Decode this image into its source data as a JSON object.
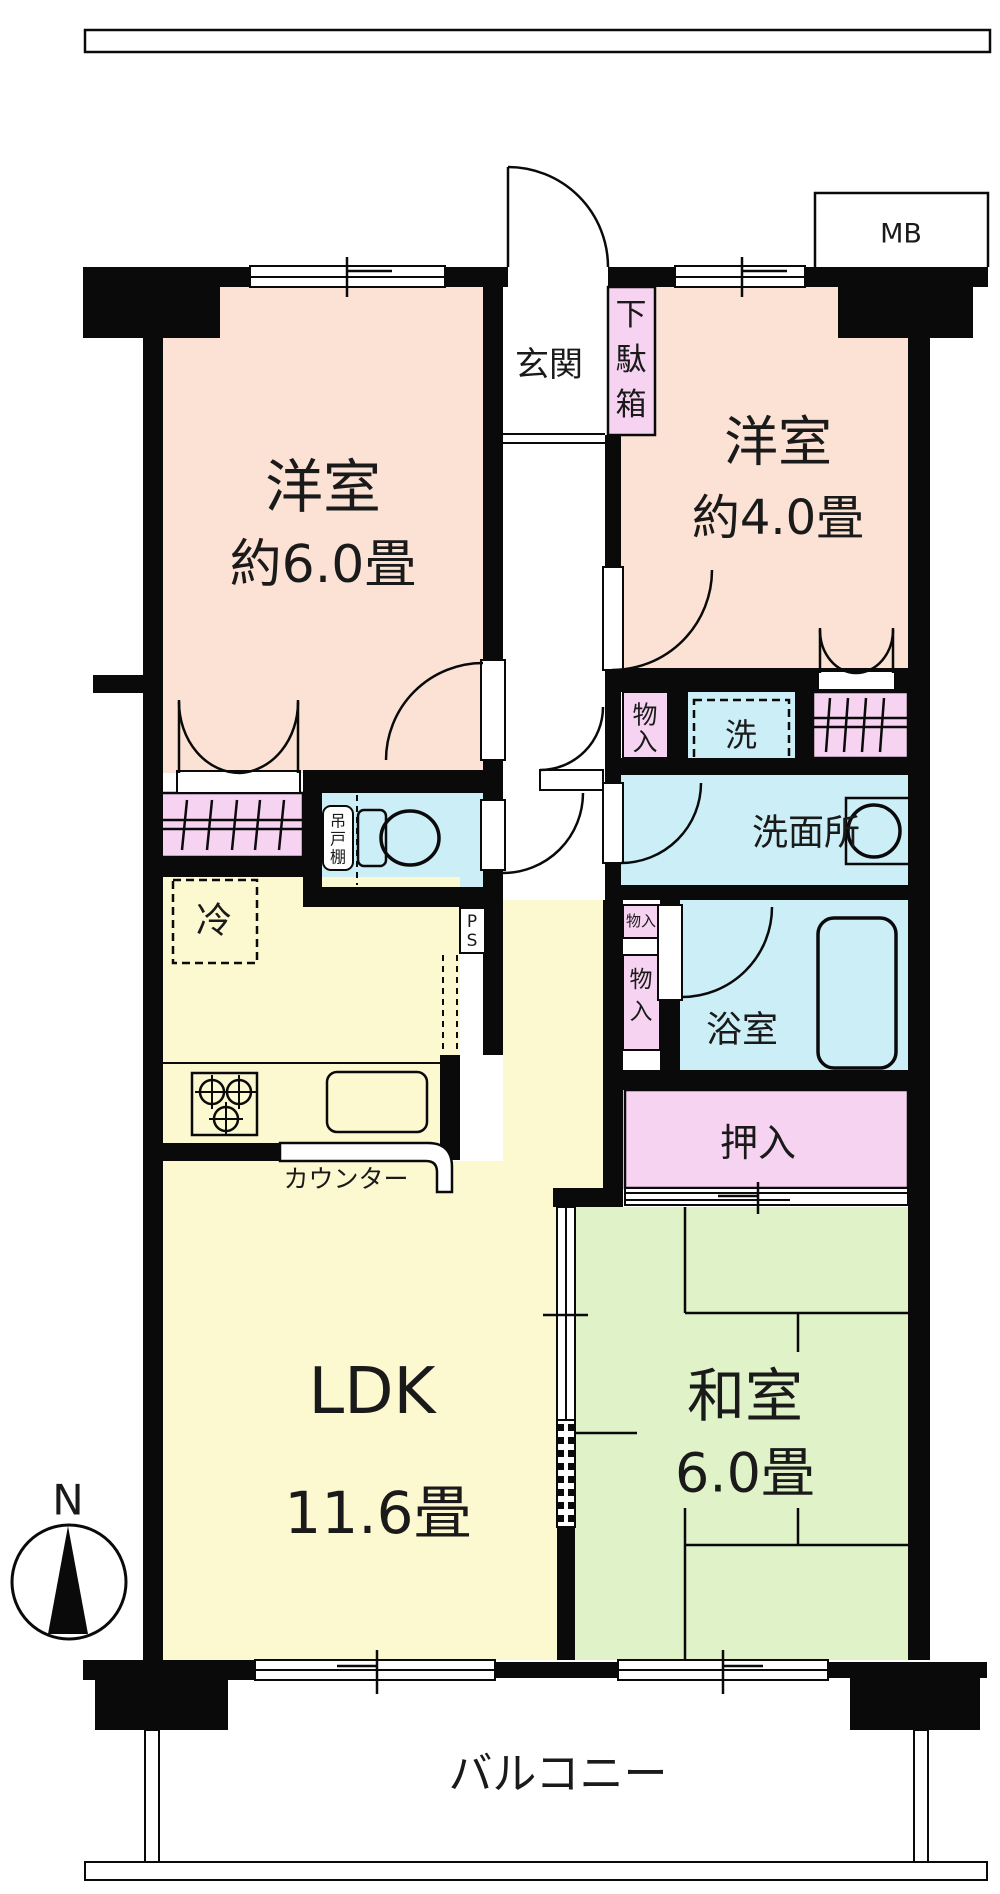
{
  "title": "apartment-floor-plan",
  "colors": {
    "wall": "#0a0a0a",
    "western_room": "#fbe2d5",
    "storage_pink": "#f7d3f2",
    "water_blue": "#cceef6",
    "ldk_yellow": "#fcf8d0",
    "tatami_green": "#e0f2c8",
    "background": "#ffffff"
  },
  "compass": {
    "north_label": "N"
  },
  "meter_box": {
    "label": "MB"
  },
  "rooms": {
    "west1": {
      "name": "洋室",
      "size": "約6.0畳"
    },
    "west2": {
      "name": "洋室",
      "size": "約4.0畳"
    },
    "ldk": {
      "name": "LDK",
      "size": "11.6畳"
    },
    "washitsu": {
      "name": "和室",
      "size": "6.0畳"
    },
    "genkan": {
      "label": "玄関"
    },
    "washroom": {
      "label": "洗面所"
    },
    "bath": {
      "label": "浴室"
    },
    "balcony": {
      "label": "バルコニー"
    }
  },
  "storage": {
    "getabako_chars": [
      "下",
      "駄",
      "箱"
    ],
    "monoire_top_chars": [
      "物",
      "入"
    ],
    "monoire_small": "物入",
    "monoire2_chars": [
      "物",
      "入"
    ],
    "oshiire": "押入",
    "tsuridana_chars": [
      "吊",
      "戸",
      "棚"
    ]
  },
  "fixtures": {
    "laundry": "洗",
    "refrigerator": "冷",
    "counter": "カウンター",
    "pipe_space_chars": [
      "P",
      "S"
    ]
  }
}
